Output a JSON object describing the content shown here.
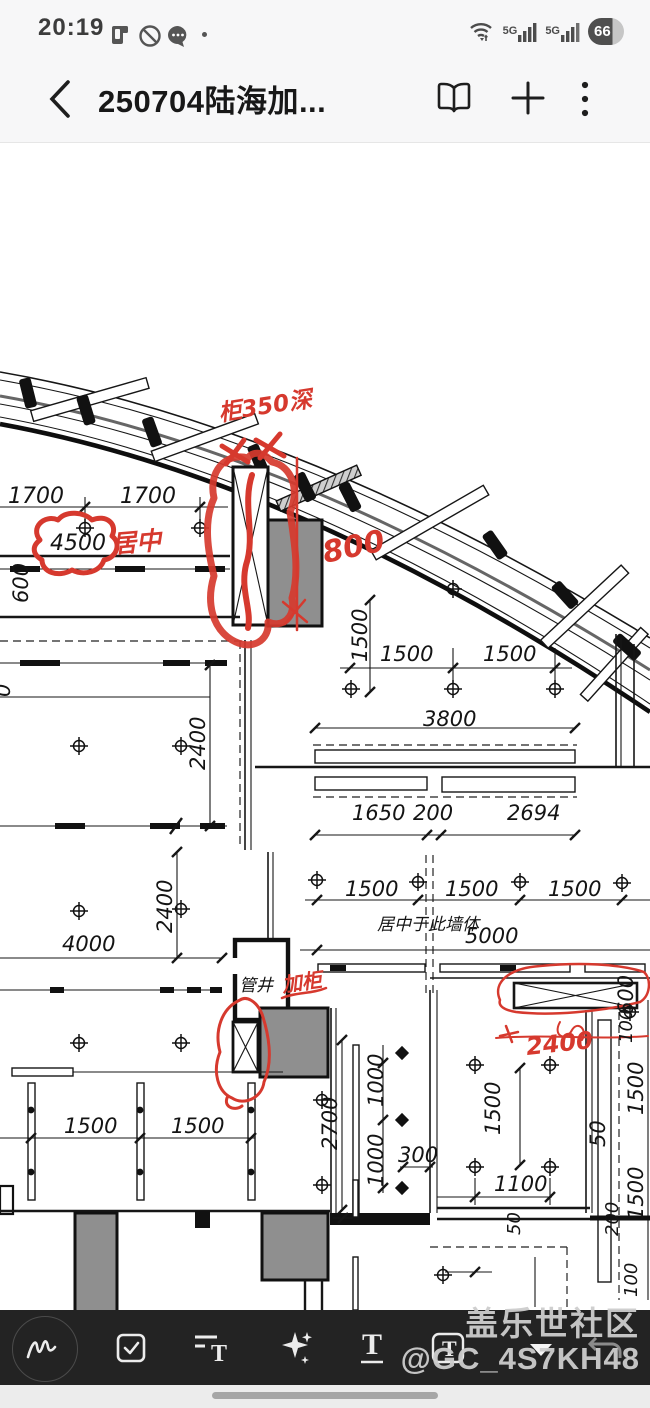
{
  "status_bar": {
    "time": "20:19",
    "battery_percent": "66",
    "network_badge_1": "5G",
    "network_badge_2": "5G",
    "left_icons": [
      "sim-device-icon",
      "mute-circle-icon",
      "chat-bubble-icon",
      "notification-dot"
    ],
    "right_icons": [
      "wifi-traffic-icon",
      "signal-bars-icon",
      "signal-bars-icon",
      "battery-badge"
    ]
  },
  "header": {
    "back_glyph": "‹",
    "title": "250704陆海加...",
    "actions": [
      "reader-mode-icon",
      "add-page-icon",
      "more-menu-icon"
    ]
  },
  "toolbar": {
    "items": [
      {
        "name": "handwriting-pen"
      },
      {
        "name": "checklist"
      },
      {
        "name": "text-format"
      },
      {
        "name": "ai-sparkles"
      },
      {
        "name": "text-style"
      },
      {
        "name": "text-box"
      }
    ],
    "text_glyph": "T"
  },
  "watermark": {
    "line1": "盖乐世社区",
    "line2": "@GC_4S7KH48"
  },
  "drawing": {
    "dim_labels": [
      {
        "t": "1700",
        "x": 8,
        "y": 503,
        "s": 22
      },
      {
        "t": "1700",
        "x": 120,
        "y": 503,
        "s": 22
      },
      {
        "t": "4500",
        "x": 50,
        "y": 550,
        "s": 22
      },
      {
        "t": "600",
        "x": 28,
        "y": 603,
        "r": -90
      },
      {
        "t": "0",
        "x": 10,
        "y": 697,
        "r": -90
      },
      {
        "t": "2400",
        "x": 205,
        "y": 770,
        "r": -90
      },
      {
        "t": "1500",
        "x": 367,
        "y": 662,
        "r": -90
      },
      {
        "t": "1500",
        "x": 380,
        "y": 661
      },
      {
        "t": "1500",
        "x": 483,
        "y": 661
      },
      {
        "t": "3800",
        "x": 423,
        "y": 726
      },
      {
        "t": "1650",
        "x": 352,
        "y": 820
      },
      {
        "t": "200",
        "x": 413,
        "y": 820
      },
      {
        "t": "2694",
        "x": 507,
        "y": 820
      },
      {
        "t": "1500",
        "x": 345,
        "y": 896
      },
      {
        "t": "1500",
        "x": 445,
        "y": 896
      },
      {
        "t": "1500",
        "x": 548,
        "y": 896
      },
      {
        "t": "居中于此墙体",
        "x": 377,
        "y": 930,
        "s": 17
      },
      {
        "t": "5000",
        "x": 465,
        "y": 943
      },
      {
        "t": "2400",
        "x": 172,
        "y": 933,
        "r": -90
      },
      {
        "t": "4000",
        "x": 62,
        "y": 951
      },
      {
        "t": "管井",
        "x": 239,
        "y": 991,
        "s": 17
      },
      {
        "t": "600",
        "x": 633,
        "y": 1015,
        "r": -90
      },
      {
        "t": "100",
        "x": 632,
        "y": 1043,
        "r": -90,
        "s": 18
      },
      {
        "t": "1500",
        "x": 643,
        "y": 1115,
        "r": -90
      },
      {
        "t": "50",
        "x": 605,
        "y": 1147,
        "r": -90
      },
      {
        "t": "1500",
        "x": 643,
        "y": 1220,
        "r": -90
      },
      {
        "t": "200",
        "x": 618,
        "y": 1236,
        "r": -90,
        "s": 18
      },
      {
        "t": "100",
        "x": 637,
        "y": 1297,
        "r": -90,
        "s": 18
      },
      {
        "t": "2700",
        "x": 337,
        "y": 1150,
        "r": -90
      },
      {
        "t": "1000",
        "x": 383,
        "y": 1107,
        "r": -90
      },
      {
        "t": "1000",
        "x": 383,
        "y": 1187,
        "r": -90
      },
      {
        "t": "300",
        "x": 398,
        "y": 1162
      },
      {
        "t": "1500",
        "x": 500,
        "y": 1135,
        "r": -90
      },
      {
        "t": "1100",
        "x": 494,
        "y": 1191
      },
      {
        "t": "1500",
        "x": 64,
        "y": 1133
      },
      {
        "t": "1500",
        "x": 171,
        "y": 1133
      },
      {
        "t": "50",
        "x": 520,
        "y": 1235,
        "r": -90,
        "s": 18
      }
    ],
    "red_labels": [
      {
        "t": "柜350深",
        "x": 220,
        "y": 421,
        "r": -9,
        "s": 23
      },
      {
        "t": "800",
        "x": 325,
        "y": 563,
        "r": -12,
        "s": 30
      },
      {
        "t": "居中",
        "x": 112,
        "y": 553,
        "r": -5,
        "s": 25
      },
      {
        "t": "加柜",
        "x": 283,
        "y": 992,
        "r": -8,
        "s": 20
      },
      {
        "t": "2400",
        "x": 527,
        "y": 1055,
        "r": -6,
        "s": 24
      }
    ],
    "targets": [
      [
        85,
        528
      ],
      [
        200,
        528
      ],
      [
        79,
        746
      ],
      [
        181,
        746
      ],
      [
        79,
        911
      ],
      [
        181,
        909
      ],
      [
        453,
        589
      ],
      [
        351,
        689
      ],
      [
        453,
        689
      ],
      [
        555,
        689
      ],
      [
        317,
        880
      ],
      [
        418,
        882
      ],
      [
        520,
        882
      ],
      [
        622,
        883
      ],
      [
        79,
        1043
      ],
      [
        181,
        1043
      ],
      [
        322,
        1100
      ],
      [
        322,
        1185
      ],
      [
        475,
        1065
      ],
      [
        550,
        1065
      ],
      [
        475,
        1167
      ],
      [
        550,
        1167
      ],
      [
        443,
        1275
      ],
      [
        630,
        1012
      ]
    ],
    "diamonds": [
      [
        402,
        1053
      ],
      [
        402,
        1120
      ],
      [
        402,
        1188
      ]
    ],
    "dots": [
      [
        31,
        1110
      ],
      [
        31,
        1172
      ],
      [
        140,
        1110
      ],
      [
        140,
        1172
      ],
      [
        251,
        1110
      ],
      [
        251,
        1172
      ]
    ],
    "fins": [
      [
        28,
        393,
        -14
      ],
      [
        86,
        410,
        -17
      ],
      [
        152,
        432,
        -20
      ],
      [
        258,
        459,
        -23
      ],
      [
        305,
        487,
        -26
      ],
      [
        350,
        497,
        -27
      ],
      [
        495,
        545,
        -35
      ],
      [
        565,
        595,
        -42
      ],
      [
        627,
        647,
        -48
      ]
    ]
  }
}
